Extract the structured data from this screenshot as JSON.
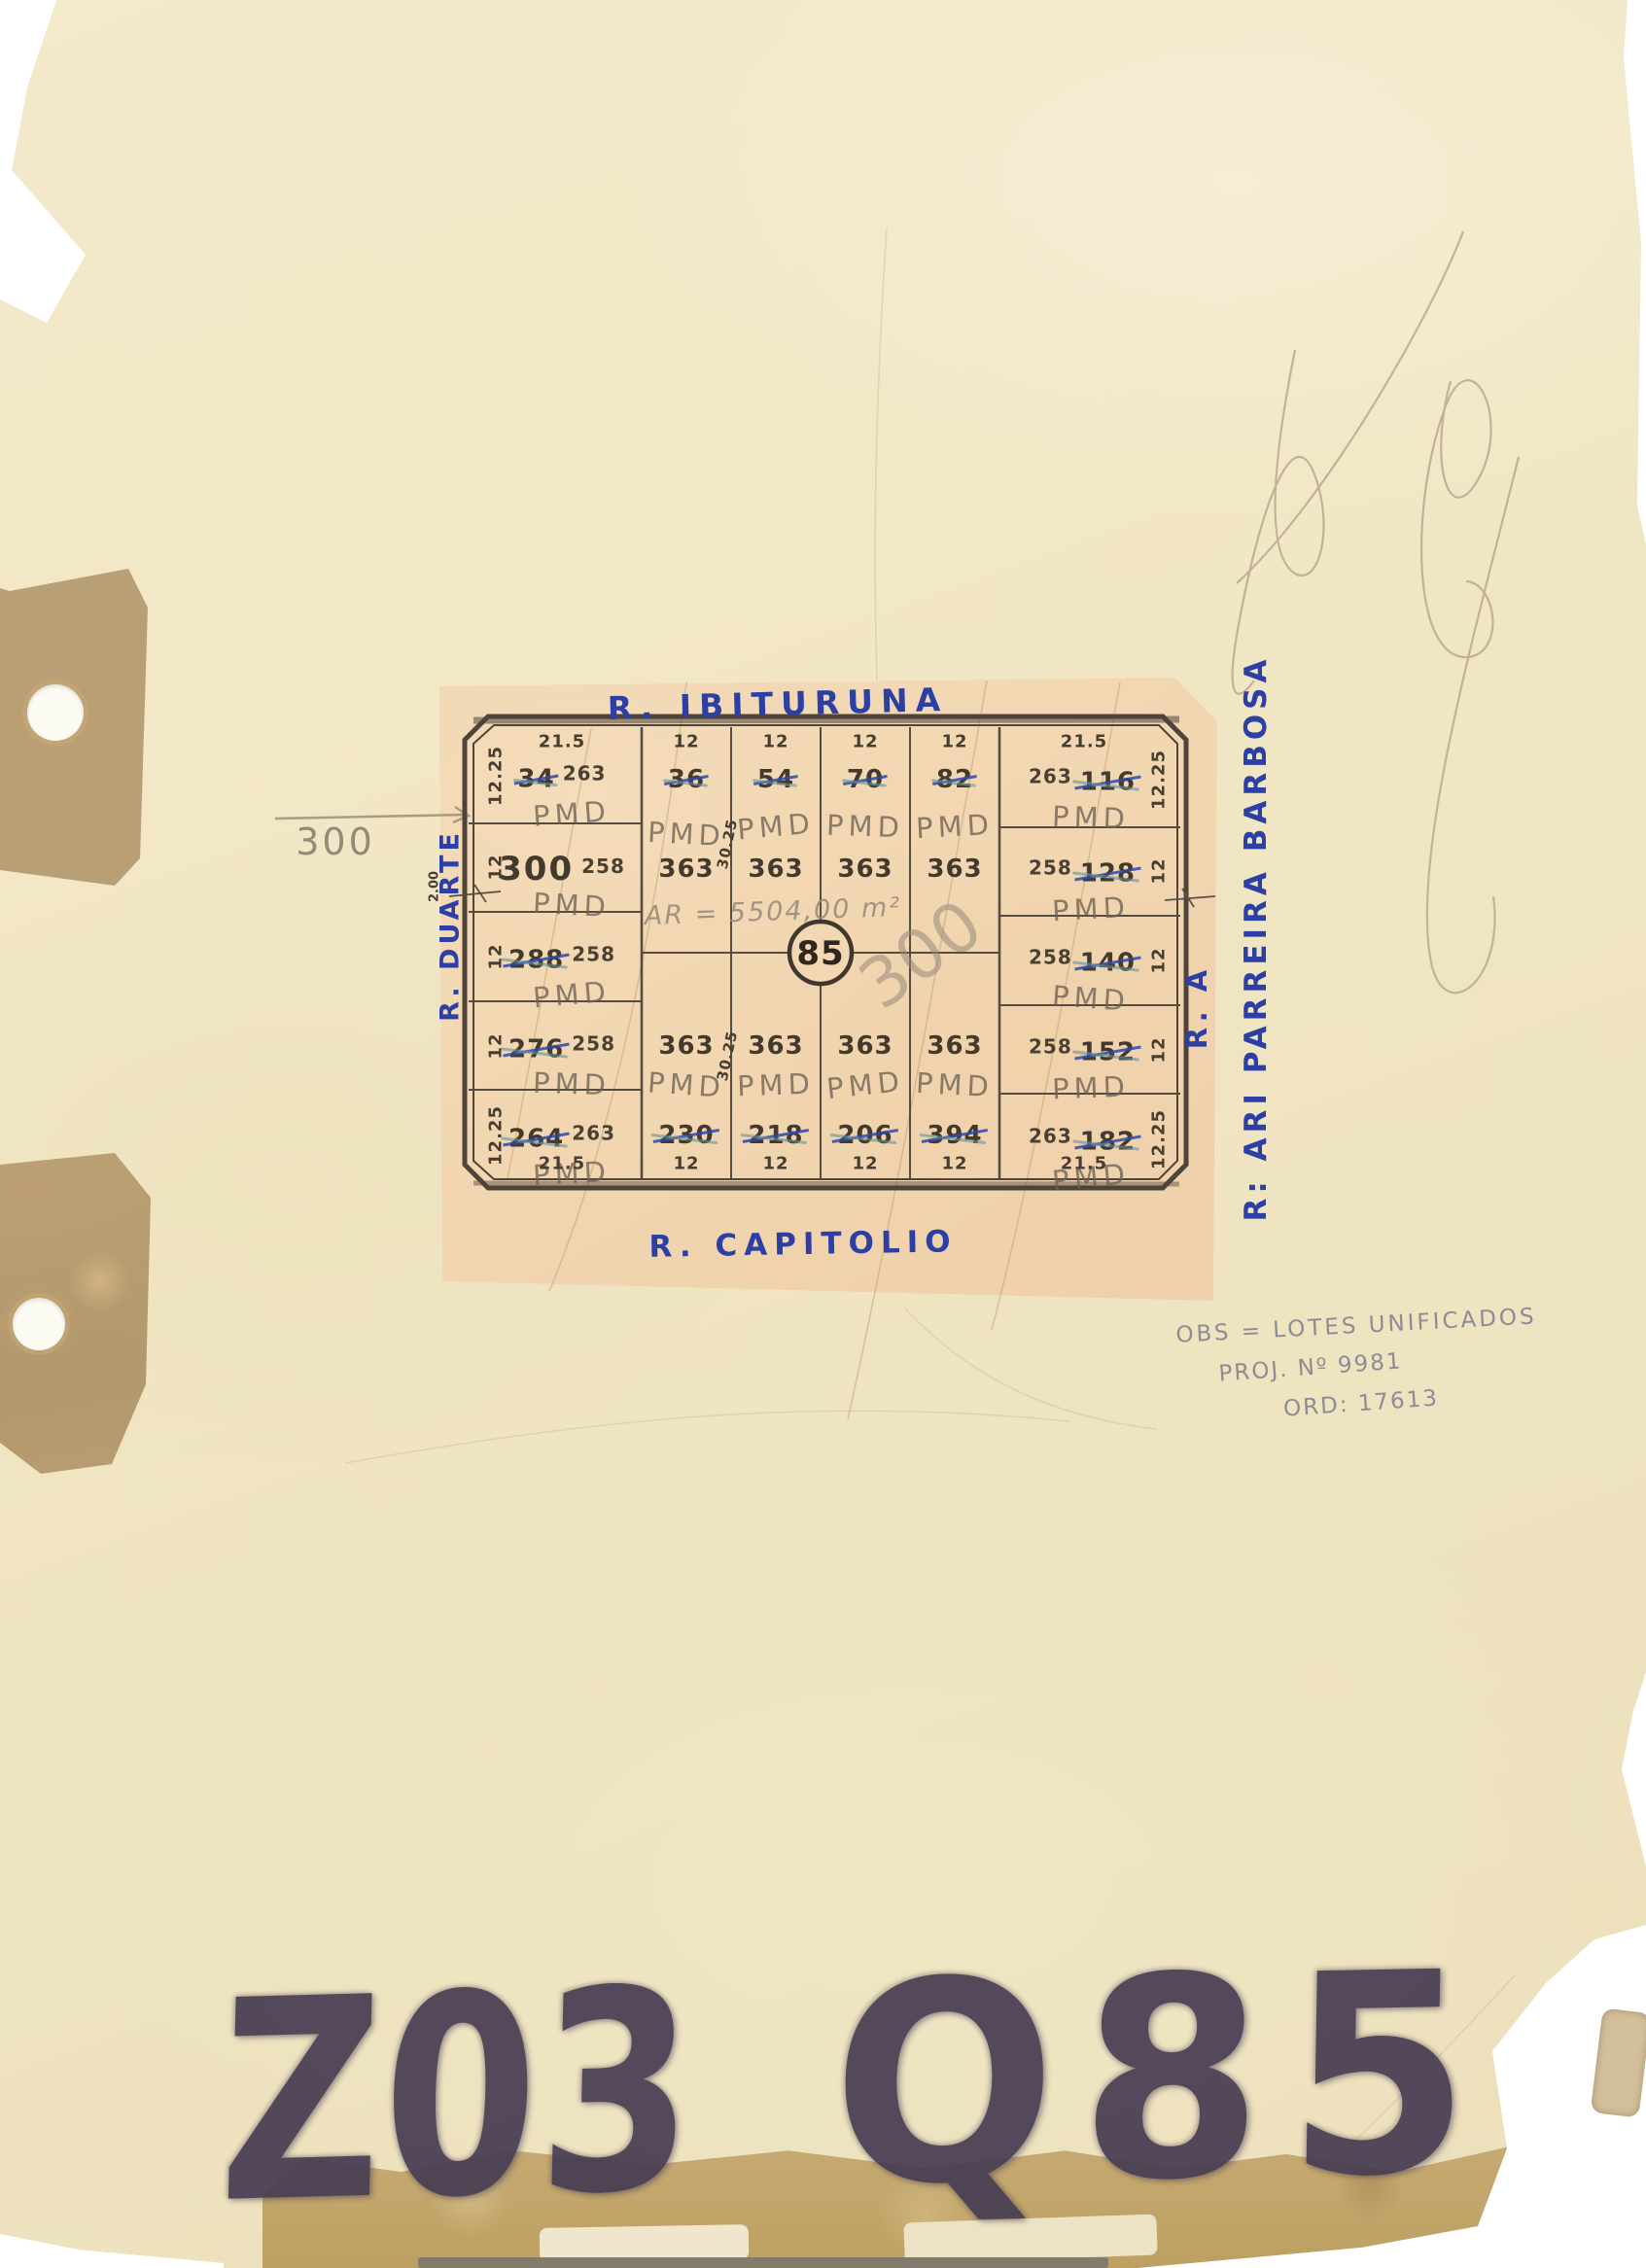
{
  "annotations": {
    "measure_left": "300",
    "area_note": "AR = 5504,00 m²",
    "unified_lot": "300",
    "obs_line1": "OBS = LOTES UNIFICADOS",
    "obs_line2": "PROJ. Nº 9981",
    "obs_line3": "ORD: 17613",
    "bottom_stamp_left": "Z03",
    "bottom_stamp_right": "Q85"
  },
  "map": {
    "block_number": "85",
    "stamp": "PMD",
    "border_note": "2.00",
    "depth_label_top": "30.25",
    "depth_label_bottom": "30.25",
    "streets": {
      "top": "R. IBITURUNA",
      "bottom": "R. CAPITOLIO",
      "left": "R. DUARTE",
      "right_inner": "R. A",
      "right_outer": "R: ARI PARREIRA BARBOSA"
    },
    "edge_top": [
      "21.5",
      "12",
      "12",
      "12",
      "12",
      "21.5"
    ],
    "edge_bottom": [
      "21.5",
      "12",
      "12",
      "12",
      "12",
      "21.5"
    ],
    "edge_left": [
      "12.25",
      "12",
      "12",
      "12",
      "12.25"
    ],
    "edge_right": [
      "12.25",
      "12",
      "12",
      "12",
      "12.25"
    ],
    "lots_left": [
      {
        "number": "34",
        "area": "263",
        "crossed": true
      },
      {
        "number": "300",
        "area": "258",
        "crossed": false
      },
      {
        "number": "288",
        "area": "258",
        "crossed": true
      },
      {
        "number": "276",
        "area": "258",
        "crossed": true
      },
      {
        "number": "264",
        "area": "263",
        "crossed": true
      }
    ],
    "lots_right": [
      {
        "number": "116",
        "area": "263",
        "crossed": true
      },
      {
        "number": "128",
        "area": "258",
        "crossed": true
      },
      {
        "number": "140",
        "area": "258",
        "crossed": true
      },
      {
        "number": "152",
        "area": "258",
        "crossed": true
      },
      {
        "number": "182",
        "area": "263",
        "crossed": true
      }
    ],
    "lots_middle_top": [
      {
        "number": "36",
        "area": "363",
        "crossed": true
      },
      {
        "number": "54",
        "area": "363",
        "crossed": true
      },
      {
        "number": "70",
        "area": "363",
        "crossed": true
      },
      {
        "number": "82",
        "area": "363",
        "crossed": true
      }
    ],
    "lots_middle_bottom": [
      {
        "number": "230",
        "area": "363",
        "crossed": true
      },
      {
        "number": "218",
        "area": "363",
        "crossed": true
      },
      {
        "number": "206",
        "area": "363",
        "crossed": true
      },
      {
        "number": "394",
        "area": "363",
        "crossed": true
      }
    ],
    "colors": {
      "ink_blue": "#2c3fa4",
      "pencil_gray": "#95897a",
      "map_line": "#4e443a",
      "paper_tan": "#f1d6b1",
      "page_cream": "#f1e6c4",
      "marker_ink": "#463c52"
    }
  }
}
